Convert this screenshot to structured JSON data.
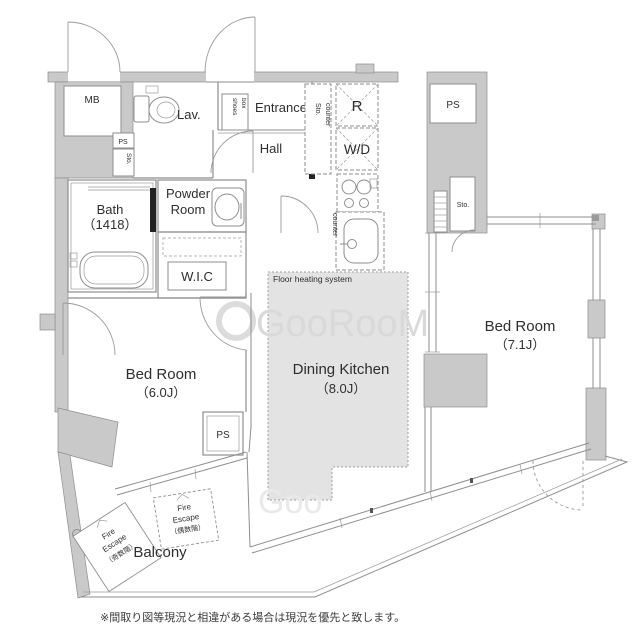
{
  "canvas": {
    "width": 640,
    "height": 640,
    "bg": "#ffffff"
  },
  "colors": {
    "wall_fill": "#c9c9c9",
    "line": "#8e8e8e",
    "floor_heating_fill": "#e3e3e3",
    "watermark": "#d9d9d9",
    "door_seal": "#222222",
    "text": "#2e2e2e"
  },
  "watermark": {
    "text": "GooRooM"
  },
  "disclaimer": "※間取り図等現況と相違がある場合は現況を優先と致します。",
  "rooms": {
    "bath": {
      "name": "Bath",
      "size": "（1418）"
    },
    "powder": {
      "lines": [
        "Powder",
        "Room"
      ]
    },
    "wic": {
      "name": "W.I.C"
    },
    "lav": {
      "name": "Lav."
    },
    "entrance": {
      "name": "Entrance"
    },
    "hall": {
      "name": "Hall"
    },
    "dining_kitchen": {
      "name": "Dining Kitchen",
      "size": "（8.0J）"
    },
    "bedroom_main": {
      "name": "Bed Room",
      "size": "（7.1J）"
    },
    "bedroom_second": {
      "name": "Bed Room",
      "size": "（6.0J）"
    },
    "balcony": {
      "name": "Balcony"
    }
  },
  "fixtures": {
    "mb": "MB",
    "ps_left": "PS",
    "sto_left": "Sto.",
    "ps_kitchen": "PS",
    "sto_bedroom": "Sto.",
    "ps_bedroom2": "PS",
    "refrigerator": "R",
    "washer_dryer": "W/D",
    "shoes_box_lines": [
      "shoes",
      "box"
    ],
    "counter_north_lines": [
      "Sto.",
      "counter"
    ],
    "counter_side": "counter"
  },
  "annotations": {
    "floor_heating": "Floor heating system",
    "fire_escape_left_lines": [
      "Fire",
      "Escape",
      "（奇数階）"
    ],
    "fire_escape_right_lines": [
      "Fire",
      "Escape",
      "（偶数階）"
    ]
  }
}
